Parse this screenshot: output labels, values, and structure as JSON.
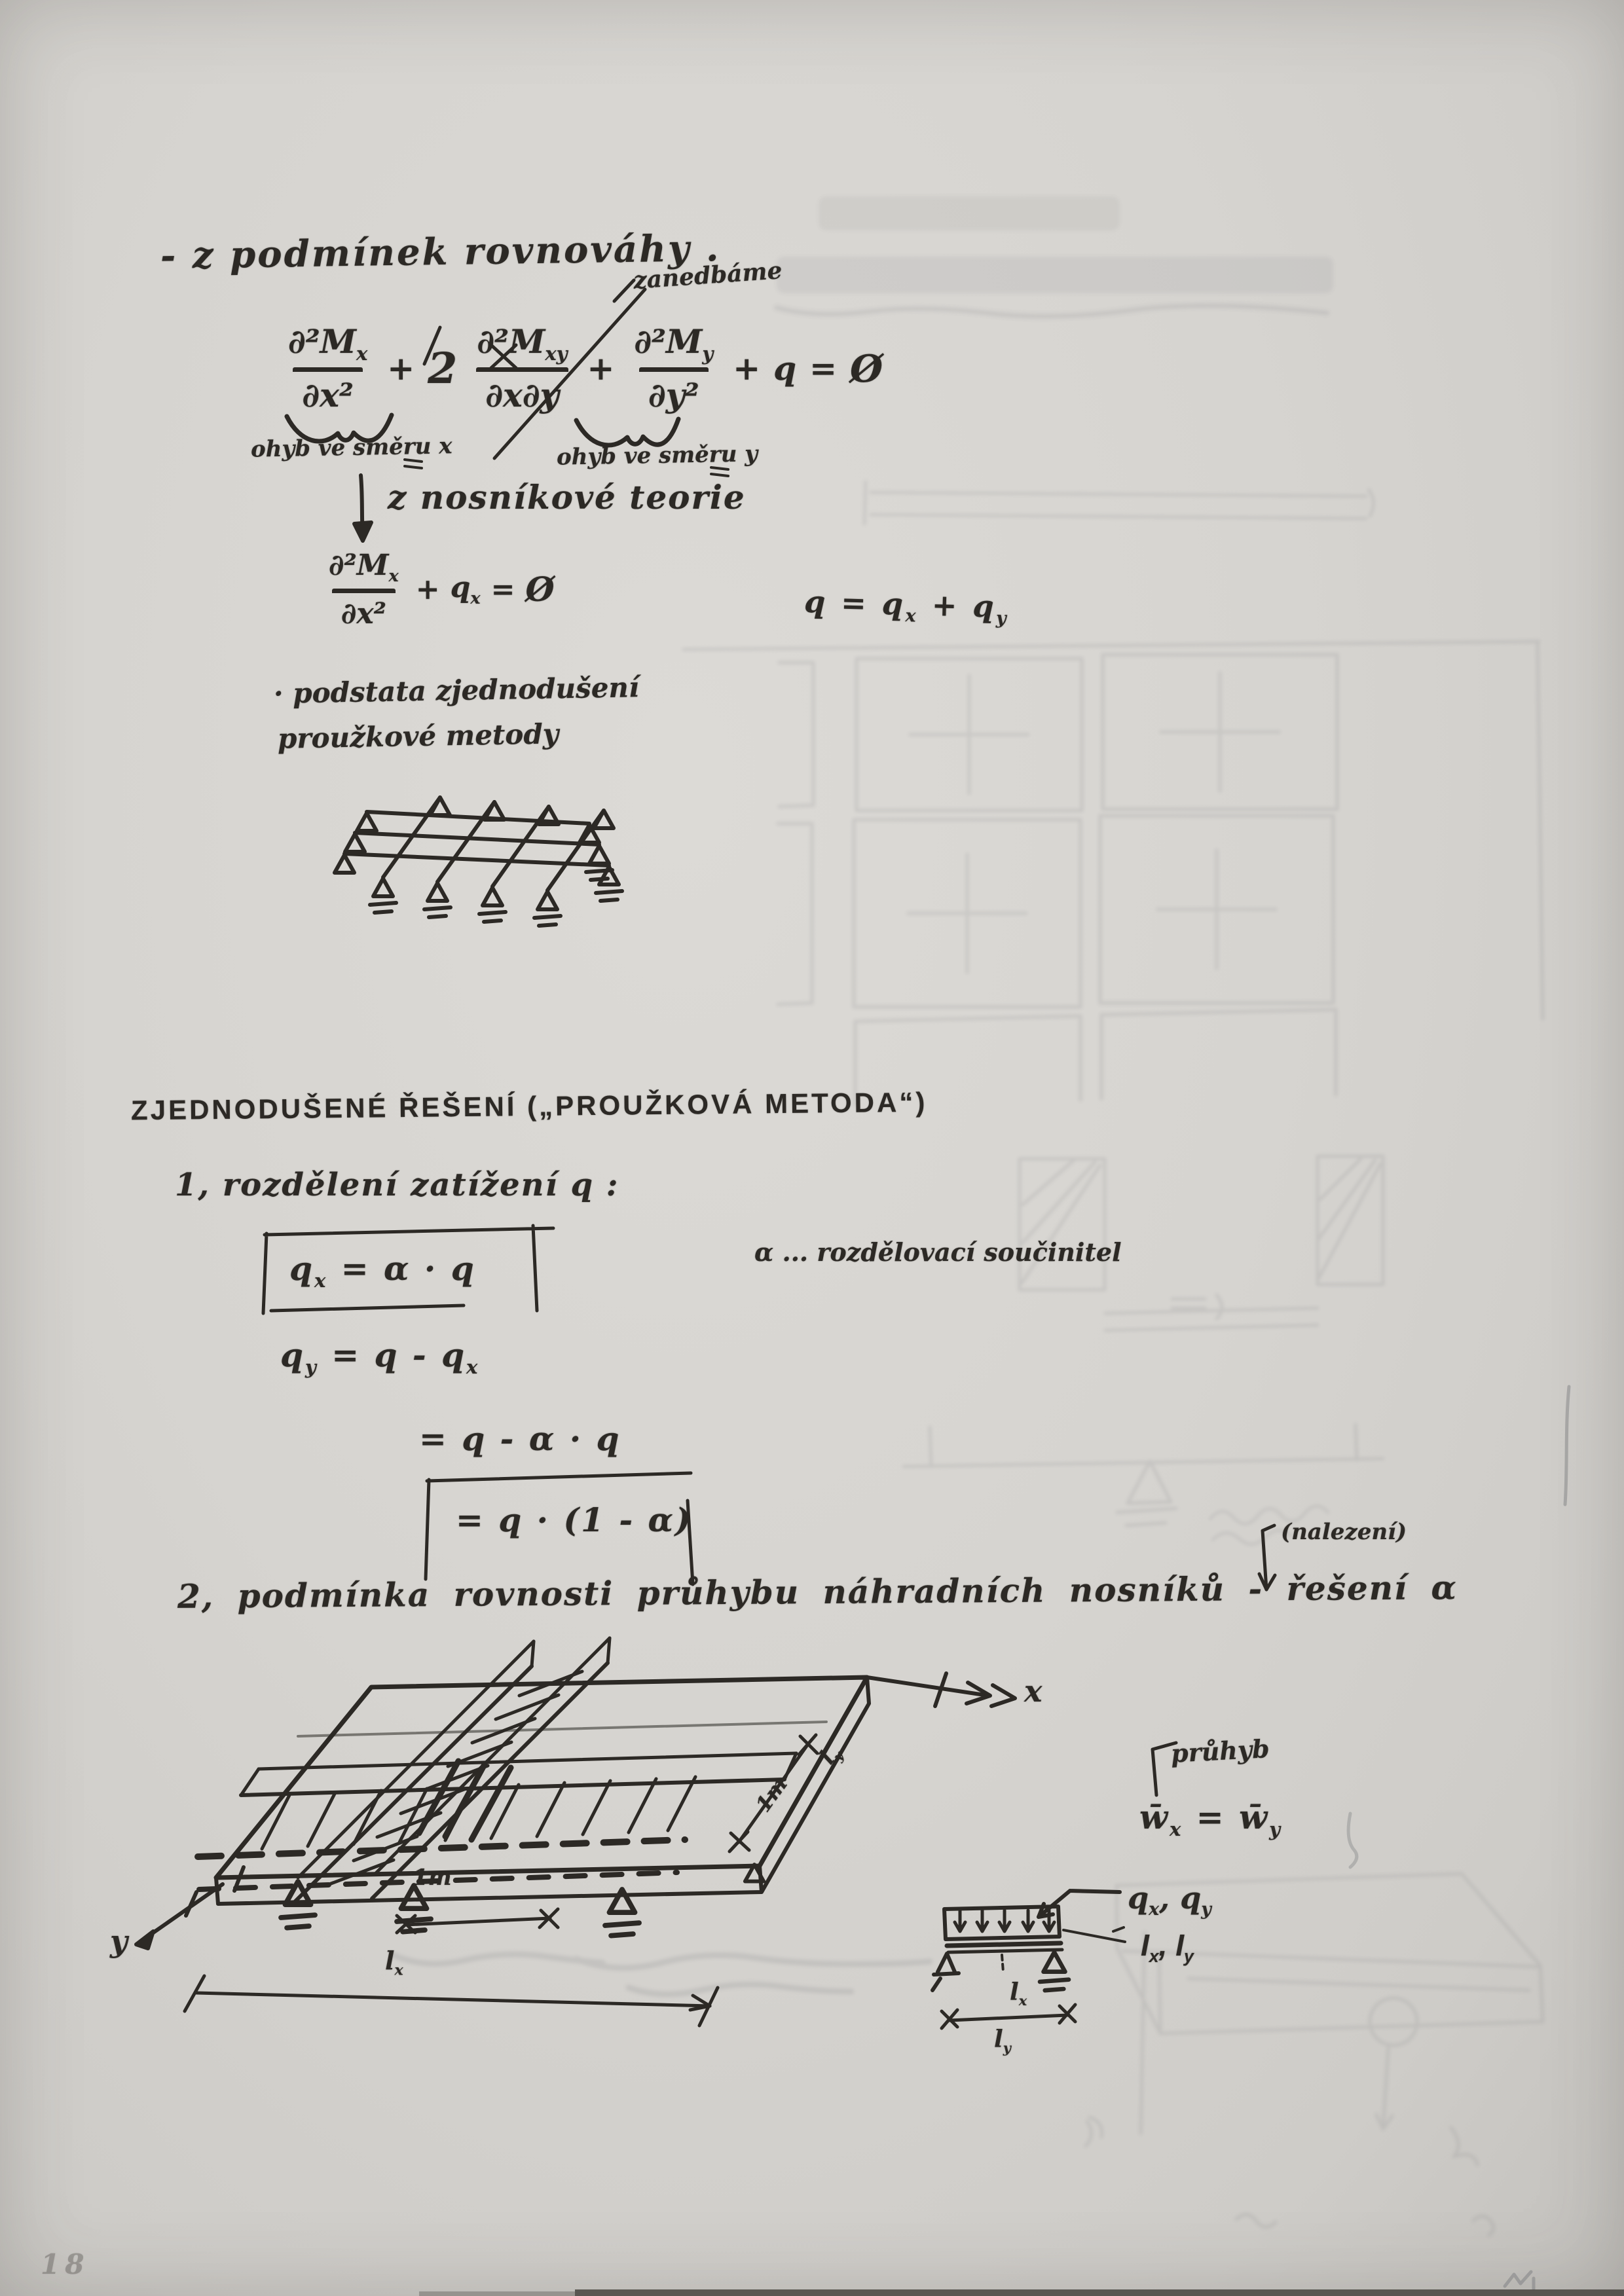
{
  "page": {
    "number": "18"
  },
  "colors": {
    "ink": "#2c2925",
    "paper": "#d6d4d0",
    "ghost": "#63656c"
  },
  "equilibrium": {
    "heading": "- z podmínek rovnováhy .",
    "neglect_note": "zanedbáme",
    "plate_eq": {
      "t1_num_base": "∂²M",
      "t1_num_sub": "x",
      "t1_den": "∂x²",
      "plus1": "+",
      "coef": "2",
      "t2_num_base": "∂²M",
      "t2_num_sub": "xy",
      "t2_den": "∂x∂y",
      "plus2": "+",
      "t3_num_base": "∂²M",
      "t3_num_sub": "y",
      "t3_den": "∂y²",
      "plus3": "+",
      "q": "q",
      "equals": "=",
      "zero": "Ø"
    },
    "underbrace_x_label": "ohyb ve směru x",
    "underbrace_y_label": "ohyb ve směru y",
    "beam_theory_note": "z nosníkové teorie",
    "beam_eq": {
      "num_base": "∂²M",
      "num_sub": "x",
      "den": "∂x²",
      "plus": "+",
      "q_base": "q",
      "q_sub": "x",
      "equals": "=",
      "zero": "Ø"
    },
    "load_sum": {
      "lhs": "q",
      "equals": "=",
      "qx_base": "q",
      "qx_sub": "x",
      "plus": "+",
      "qy_base": "q",
      "qy_sub": "y"
    },
    "essence_line1": "· podstata zjednodušení",
    "essence_line2": "proužkové metody"
  },
  "method": {
    "heading": "ZJEDNODUŠENÉ ŘEŠENÍ („PROUŽKOVÁ METODA“)",
    "step1_title": "1, rozdělení zatížení q :",
    "eq_qx": {
      "base": "q",
      "sub": "x",
      "rhs": "= α · q"
    },
    "eq_qy": {
      "base": "q",
      "sub": "y",
      "rhs": "= q - q",
      "rhs_sub": "x"
    },
    "eq_qy_line2": "= q - α · q",
    "eq_qy_line3": "= q · (1 - α)",
    "alpha_note": "α ... rozdělovací součinitel",
    "nalezeni_note": "(nalezení)",
    "step2_title": "2, podmínka rovnosti průhybu náhradních nosníků - řešení α"
  },
  "sketch_plate": {
    "axis_x": "x",
    "axis_y": "y",
    "front_width_label": "1m",
    "front_span_base": "l",
    "front_span_sub": "x",
    "side_width_label": "1m",
    "side_span_base": "l",
    "side_span_sub": "y"
  },
  "beam_detail": {
    "deflection_note": "průhyb",
    "deflection_eq": {
      "w1": "w̄",
      "w1_sub": "x",
      "equals": "=",
      "w2": "w̄",
      "w2_sub": "y"
    },
    "load_label": {
      "q1": "q",
      "q1_sub": "x",
      "comma": ", ",
      "q2": "q",
      "q2_sub": "y"
    },
    "inertia_label": {
      "i1": "I",
      "i1_sub": "x",
      "comma": ", ",
      "i2": "I",
      "i2_sub": "y"
    },
    "span_x": {
      "base": "l",
      "sub": "x"
    },
    "span_y": {
      "base": "l",
      "sub": "y"
    }
  }
}
